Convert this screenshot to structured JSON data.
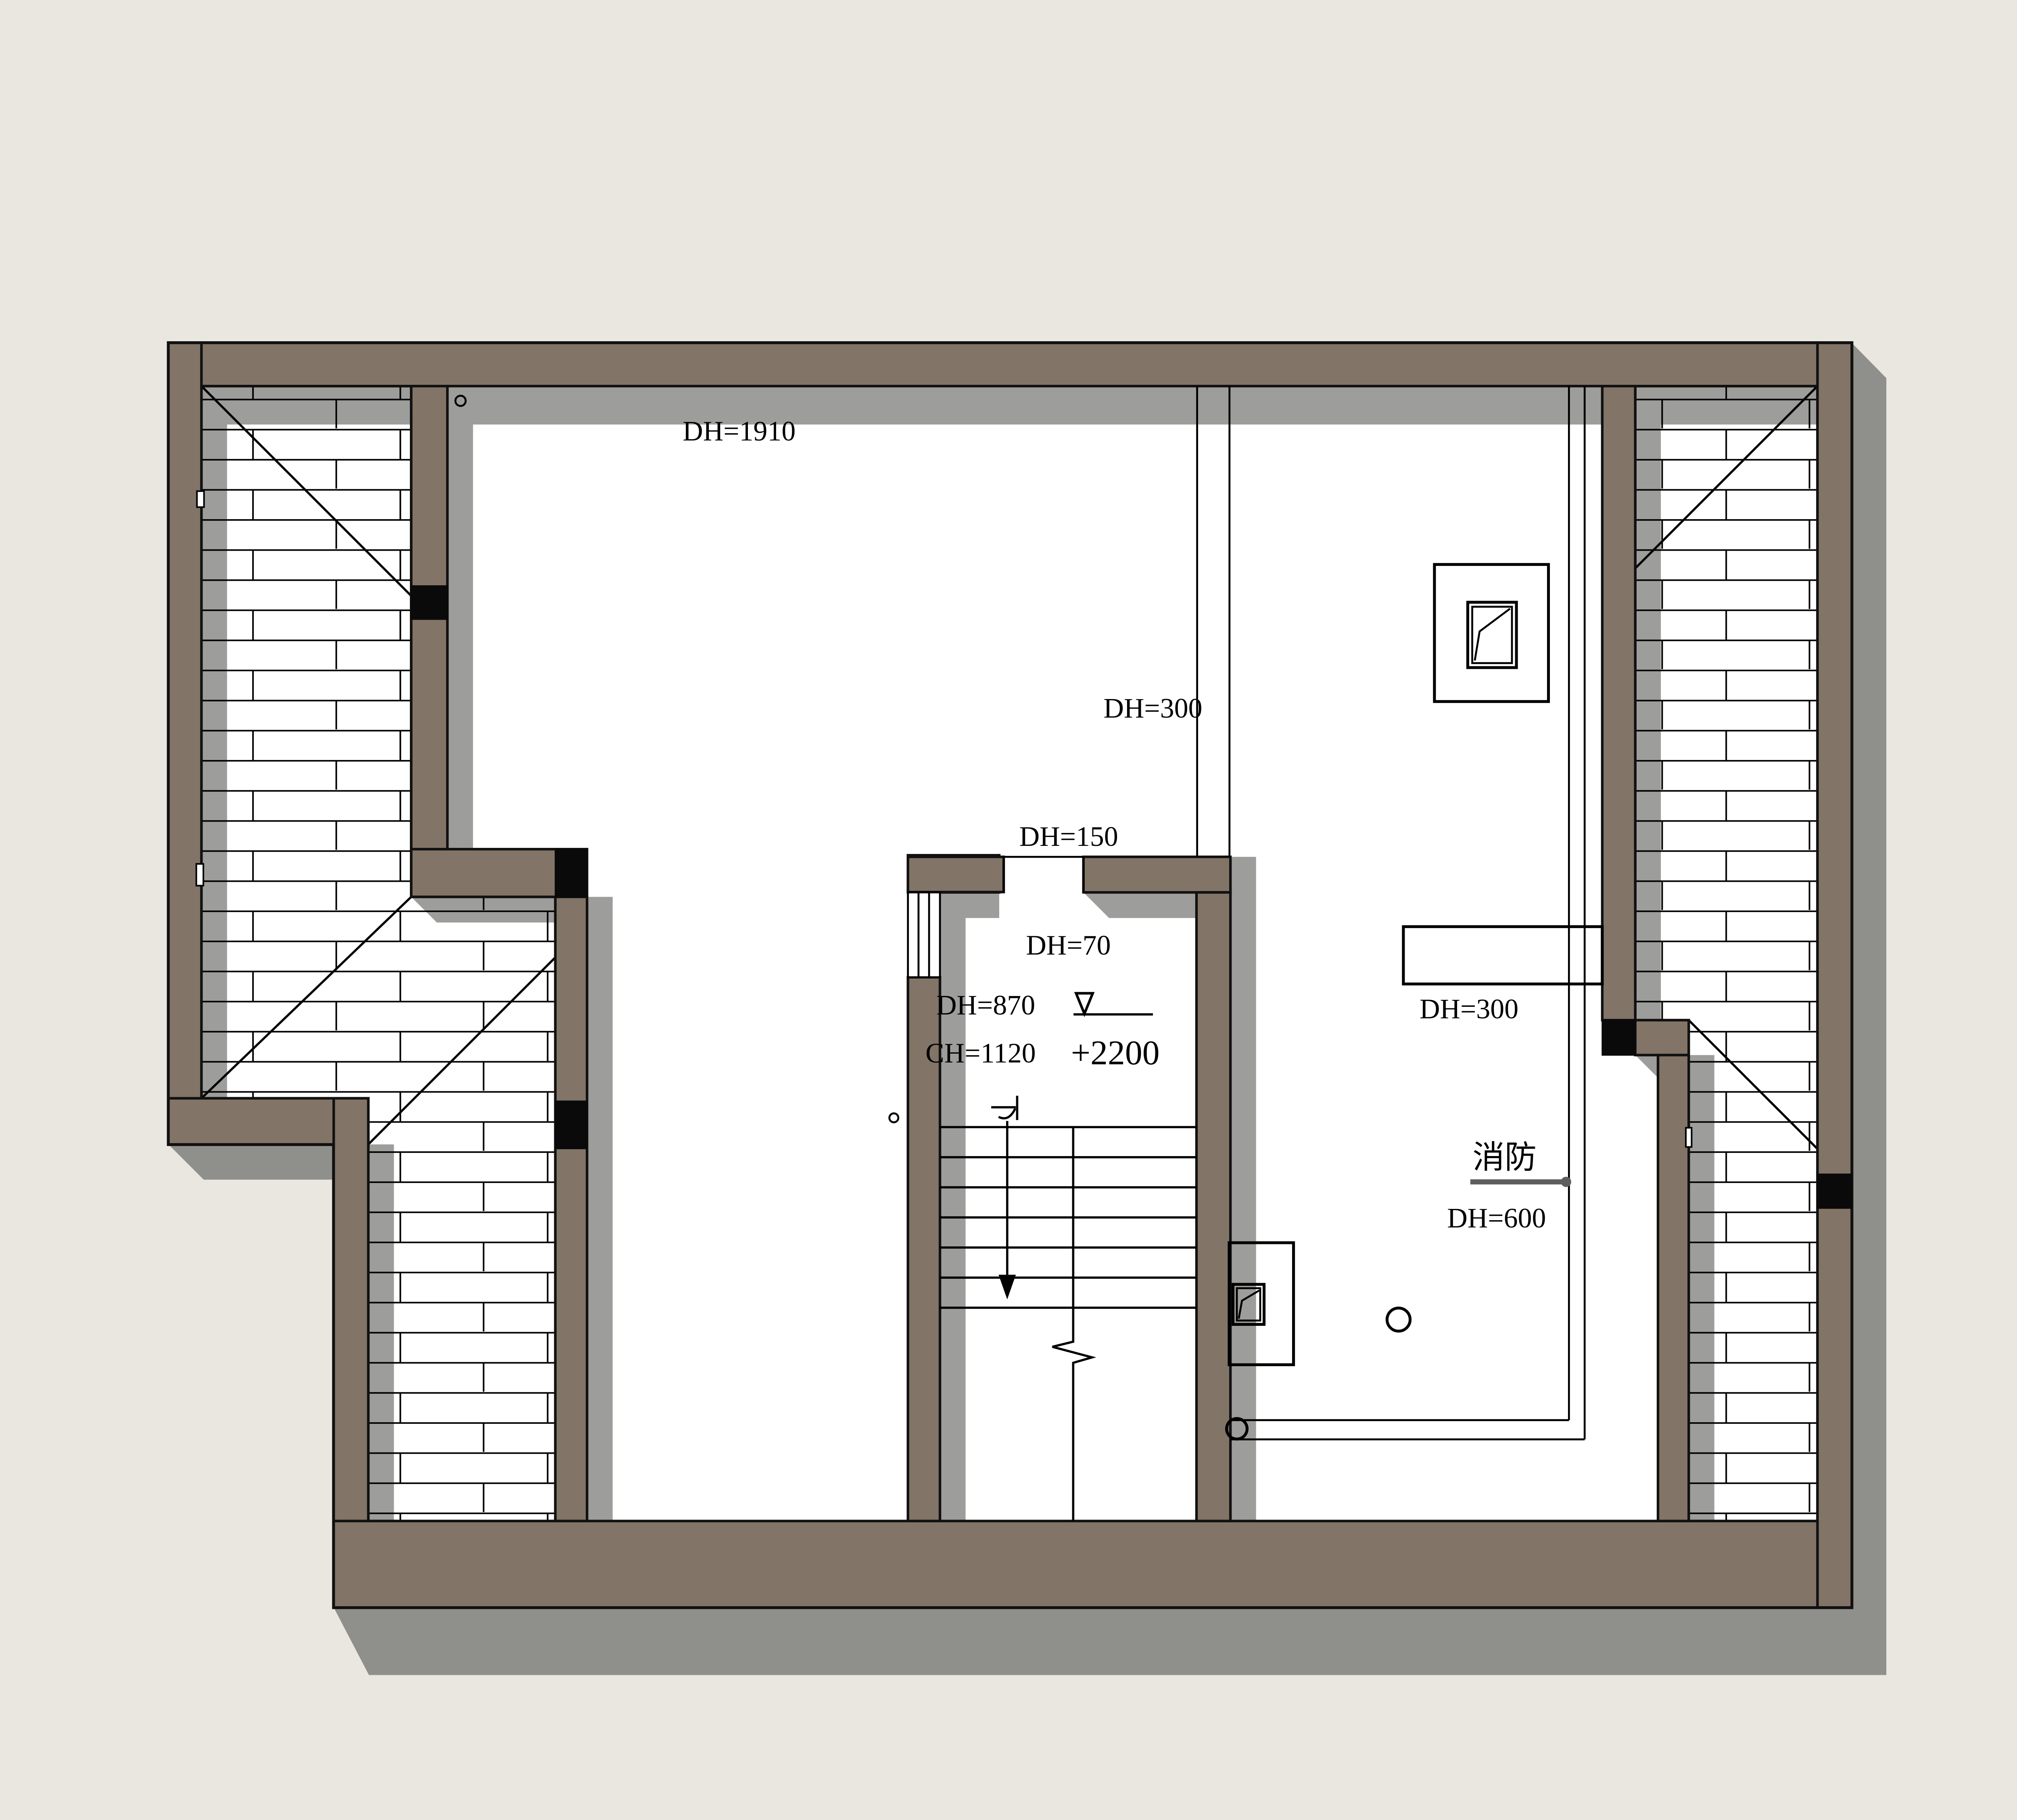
{
  "labels": {
    "door_top": "DH=1910",
    "beam_mid": "DH=300",
    "opening_upper": "DH=150",
    "opening_lower": "DH=70",
    "window_dh": "DH=870",
    "window_ch": "CH=1120",
    "level_mark": "+2200",
    "beam_right": "DH=300",
    "fire": "消防",
    "fire_dh": "DH=600"
  },
  "colors": {
    "bg": "#eae7e0",
    "wall": "#827467",
    "shadow-in": "#9d9d9b",
    "shadow-out": "#8f8f8c",
    "floor": "#ffffff",
    "line": "#000000"
  }
}
